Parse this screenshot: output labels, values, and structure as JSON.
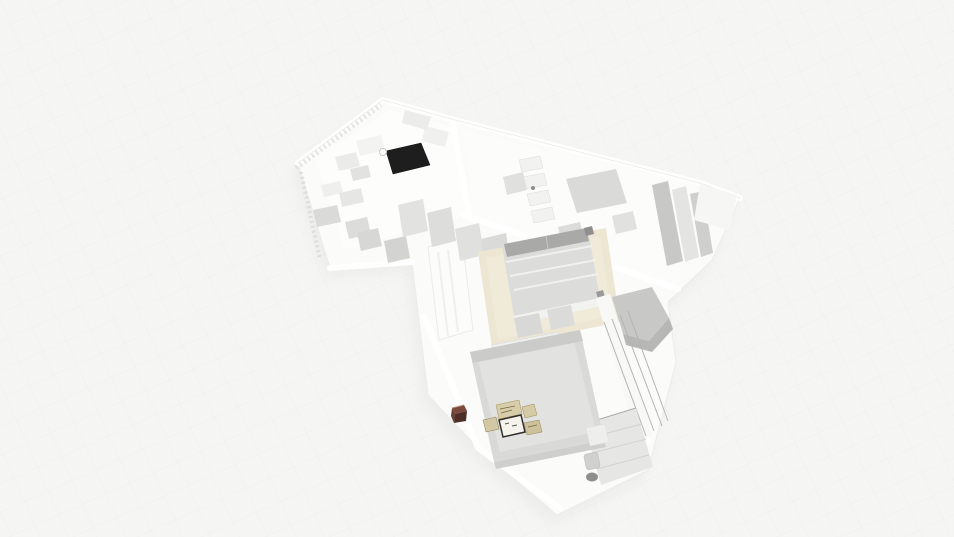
{
  "scene": {
    "view": "3d-floorplan-dollhouse-render",
    "background": "#f5f5f4",
    "grid_line": "#e9e9e7"
  },
  "palette": {
    "wall_white": "#ffffff",
    "floor_white": "#fbfbfa",
    "wall_edge": "#e7e7e5",
    "furniture_light": "#e9e9e7",
    "furniture_mid": "#dadad8",
    "furniture_dark": "#c8c8c6",
    "pillow_gray": "#a9a9a7",
    "counter_black": "#1e1e1e",
    "rug_beige": "#ece6d2",
    "bed_gray": "#d9d9d7",
    "deck_gray": "#e6e6e4",
    "railing_gray": "#b4b4b2",
    "frame_tan": "#d3c8a4",
    "frame_black": "#2e2e2c",
    "pot_brown": "#7c4a3c",
    "shadow": "#eaeae8"
  },
  "objects": [
    "kitchen-area",
    "kitchen-counter-black",
    "kitchen-sink",
    "hallway-closets",
    "bathroom-closet-room",
    "shelf-stack",
    "wardrobe-panels",
    "living-area",
    "beige-rug",
    "double-bed-center",
    "balcony",
    "balcony-railing",
    "deck-floor",
    "toilet",
    "armchair",
    "bedroom",
    "bed-large",
    "picture-frames",
    "plant-pot-brown",
    "bedside-table"
  ]
}
